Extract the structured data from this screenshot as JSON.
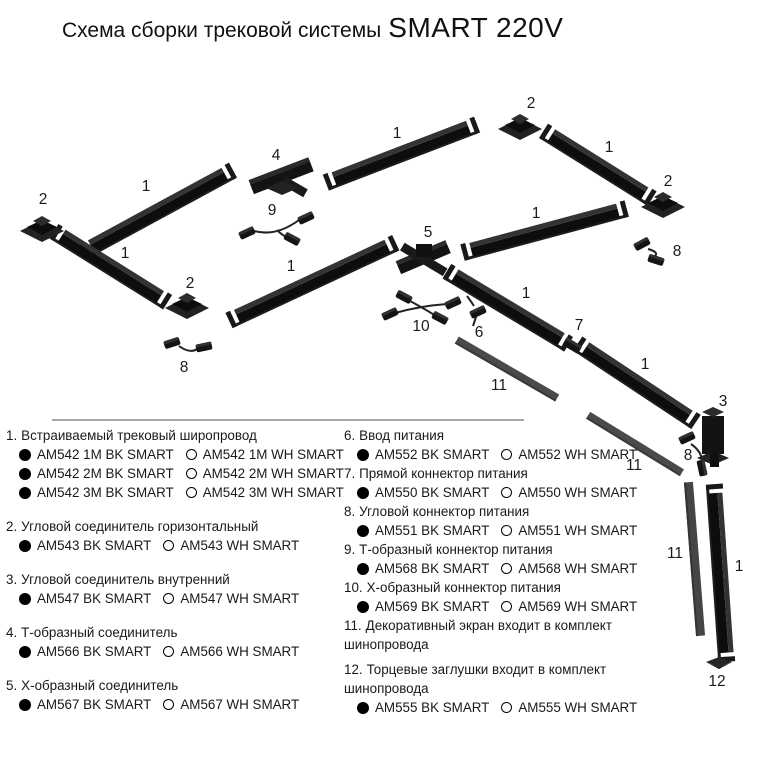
{
  "title": {
    "prefix": "Схема сборки трековой системы",
    "brand": "SMART 220V"
  },
  "colors": {
    "track_black": "#111111",
    "screen_gray": "#4a4a4a",
    "divider_gray": "#8c8c8c"
  },
  "diagram": {
    "labels": [
      "2",
      "1",
      "4",
      "9",
      "1",
      "2",
      "1",
      "2",
      "8",
      "1",
      "2",
      "8",
      "1",
      "5",
      "1",
      "10",
      "6",
      "1",
      "7",
      "11",
      "1",
      "11",
      "3",
      "8",
      "11",
      "1",
      "12"
    ]
  },
  "legend": {
    "left": [
      {
        "num": "1.",
        "name": "Встраиваемый трековый широпровод",
        "rows": [
          {
            "bk": "AM542 1M BK SMART",
            "wh": "AM542 1M WH SMART"
          },
          {
            "bk": "AM542 2M BK SMART",
            "wh": "AM542 2M WH SMART"
          },
          {
            "bk": "AM542 3M BK SMART",
            "wh": "AM542 3M WH SMART"
          }
        ]
      },
      {
        "num": "2.",
        "name": "Угловой соединитель горизонтальный",
        "rows": [
          {
            "bk": "AM543 BK SMART",
            "wh": "AM543 WH SMART"
          }
        ]
      },
      {
        "num": "3.",
        "name": "Угловой соединитель внутренний",
        "rows": [
          {
            "bk": "AM547 BK SMART",
            "wh": "AM547 WH SMART"
          }
        ]
      },
      {
        "num": "4.",
        "name": "Т-образный соединитель",
        "rows": [
          {
            "bk": "AM566 BK SMART",
            "wh": "AM566 WH SMART"
          }
        ]
      },
      {
        "num": "5.",
        "name": "Х-образный соединитель",
        "rows": [
          {
            "bk": "AM567 BK SMART",
            "wh": "AM567 WH SMART"
          }
        ]
      }
    ],
    "right": [
      {
        "num": "6.",
        "name": "Ввод питания",
        "rows": [
          {
            "bk": "AM552 BK SMART",
            "wh": "AM552 WH SMART"
          }
        ]
      },
      {
        "num": "7.",
        "name": "Прямой коннектор питания",
        "rows": [
          {
            "bk": "AM550 BK SMART",
            "wh": "AM550 WH SMART"
          }
        ]
      },
      {
        "num": "8.",
        "name": "Угловой коннектор питания",
        "rows": [
          {
            "bk": "AM551 BK SMART",
            "wh": "AM551 WH SMART"
          }
        ]
      },
      {
        "num": "9.",
        "name": "Т-образный коннектор питания",
        "rows": [
          {
            "bk": "AM568 BK SMART",
            "wh": "AM568 WH SMART"
          }
        ]
      },
      {
        "num": "10.",
        "name": "Х-образный коннектор питания",
        "rows": [
          {
            "bk": "AM569 BK SMART",
            "wh": "AM569 WH SMART"
          }
        ]
      },
      {
        "num": "11.",
        "name": "Декоративный экран входит в комплект шинопровода",
        "rows": []
      },
      {
        "num": "12.",
        "name": "Торцевые заглушки  входит в комплект шинопровода",
        "rows": [
          {
            "bk": "AM555 BK SMART",
            "wh": "AM555 WH SMART"
          }
        ]
      }
    ]
  }
}
